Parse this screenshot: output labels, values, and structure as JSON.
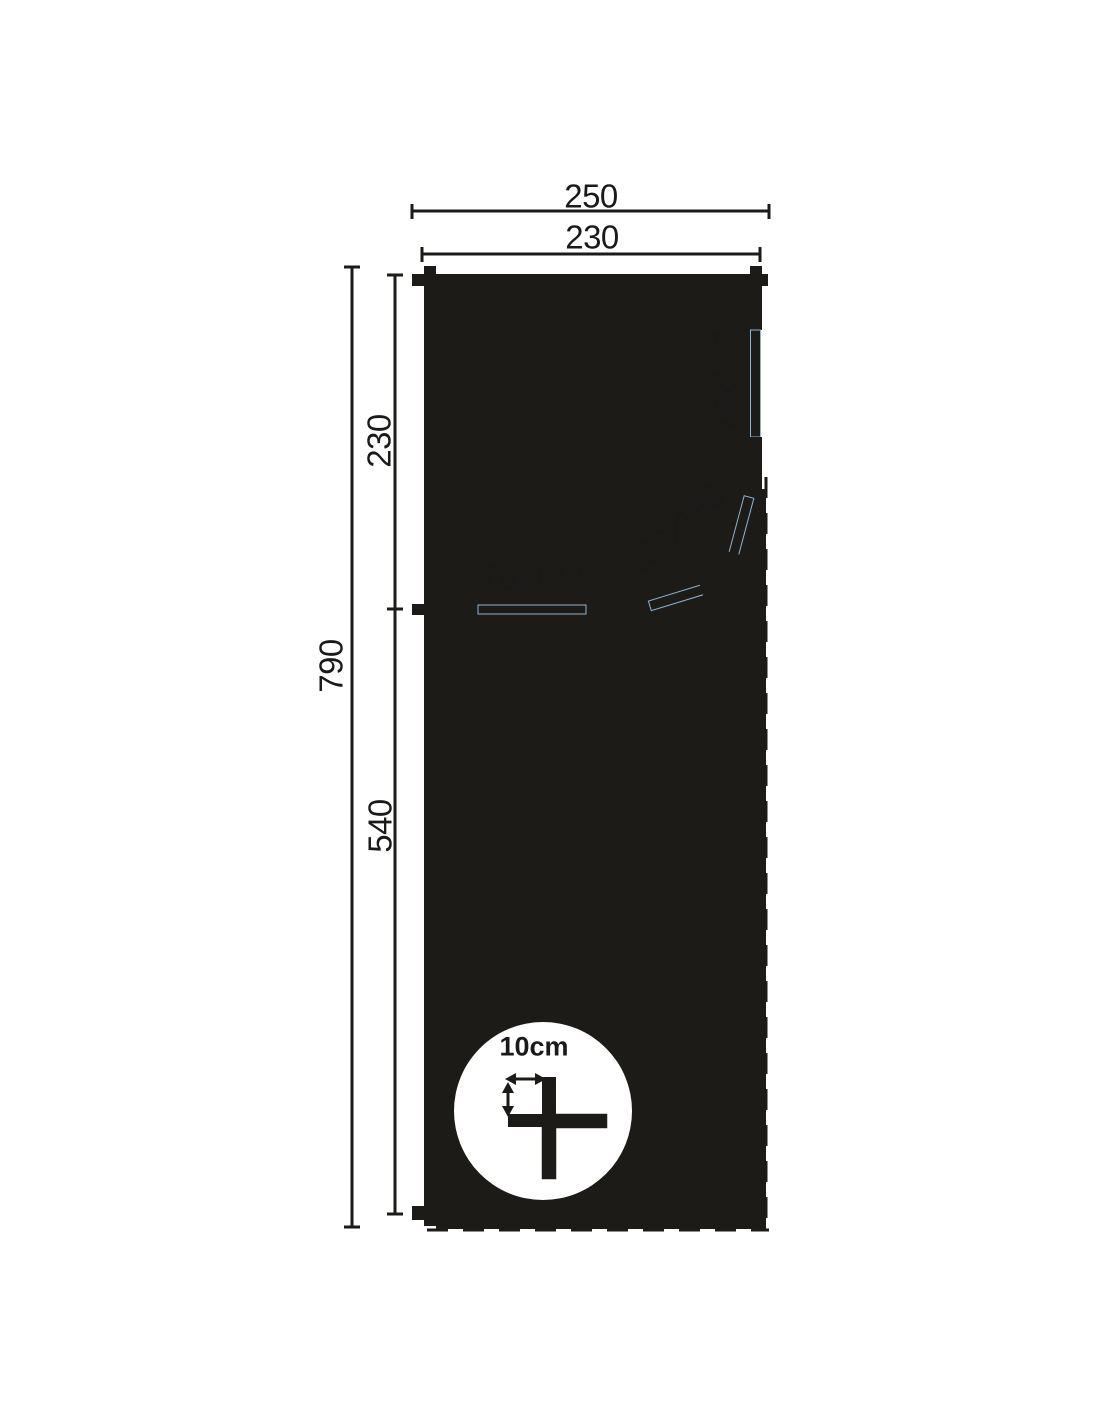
{
  "colors": {
    "wall": "#1d1b18",
    "window": "#b5d3ea",
    "window_edge": "#8fb3d2",
    "floor": "#f0f0ee",
    "dim_line": "#5a5a5a",
    "tick": "#1d1b18",
    "text": "#1a1a1a",
    "background": "#ffffff"
  },
  "plan": {
    "dimensions": {
      "overall_width": "250",
      "wall_width": "230",
      "overall_depth": "790",
      "cabin_depth": "230",
      "terrace_depth": "540"
    },
    "openings": {
      "side_window": "76x122",
      "front_window": "76x122",
      "double_door": "120x188"
    },
    "detail": {
      "log_thickness": "10cm"
    }
  }
}
